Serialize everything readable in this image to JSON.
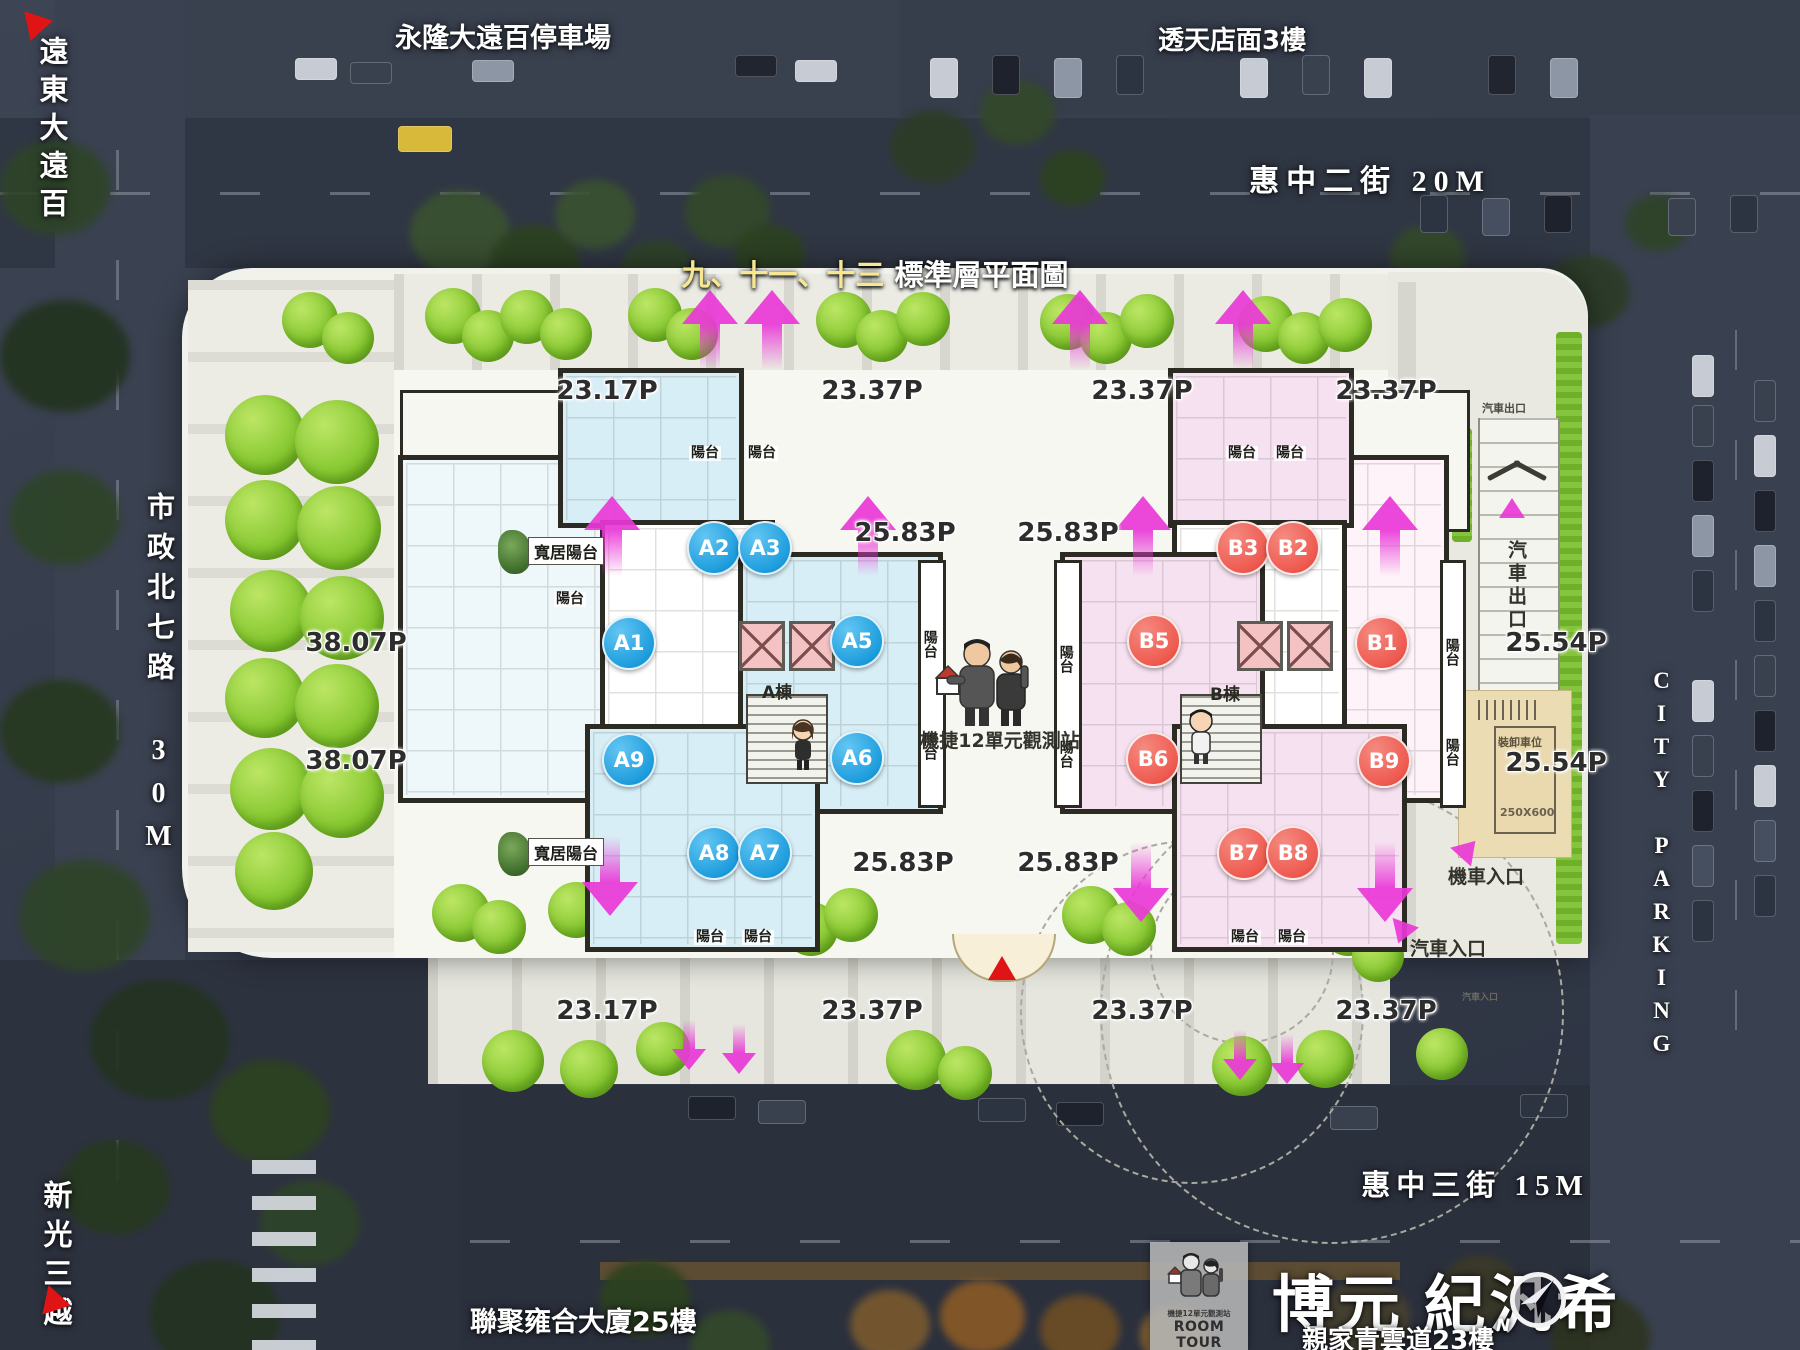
{
  "title": {
    "highlight": "九、十一、十三",
    "rest": "標準層平面圖"
  },
  "streets": {
    "top": "惠中二街  20M",
    "bottom": "惠中三街  15M",
    "left": "市政北七路 30M",
    "right_parking": "CITY PARKING"
  },
  "landmarks": {
    "far_eastern": "遠東大遠百",
    "parking_lot": "永隆大遠百停車場",
    "shophouse": "透天店面3樓",
    "shinkong": "新光三越",
    "lianju": "聯聚雍合大廈25樓"
  },
  "plan": {
    "building_a": "A棟",
    "building_b": "B棟",
    "balcony": "陽台",
    "wide_balcony": "寬居陽台",
    "observation": "機捷12單元觀測站",
    "loading": {
      "label": "裝卸車位",
      "size": "250X600"
    },
    "car_exit": "汽車出口",
    "moto_in": "機車入口",
    "car_in": "汽車入口",
    "units": {
      "a1": "A1",
      "a2": "A2",
      "a3": "A3",
      "a5": "A5",
      "a6": "A6",
      "a7": "A7",
      "a8": "A8",
      "a9": "A9",
      "b1": "B1",
      "b2": "B2",
      "b3": "B3",
      "b5": "B5",
      "b6": "B6",
      "b7": "B7",
      "b8": "B8",
      "b9": "B9"
    },
    "m": {
      "top": [
        "23.17P",
        "23.37P",
        "23.37P",
        "23.37P"
      ],
      "bottom": [
        "23.17P",
        "23.37P",
        "23.37P",
        "23.37P"
      ],
      "left": [
        "38.07P",
        "38.07P"
      ],
      "mid": [
        "25.83P",
        "25.83P",
        "25.83P",
        "25.83P"
      ],
      "right": [
        "25.54P",
        "25.54P"
      ]
    }
  },
  "branding": {
    "room_tour_small": "機捷12單元觀測站",
    "room_tour": "ROOM TOUR",
    "name": "博元 紀汎希",
    "subtitle": "親家青雲道23樓",
    "compass": "N"
  }
}
